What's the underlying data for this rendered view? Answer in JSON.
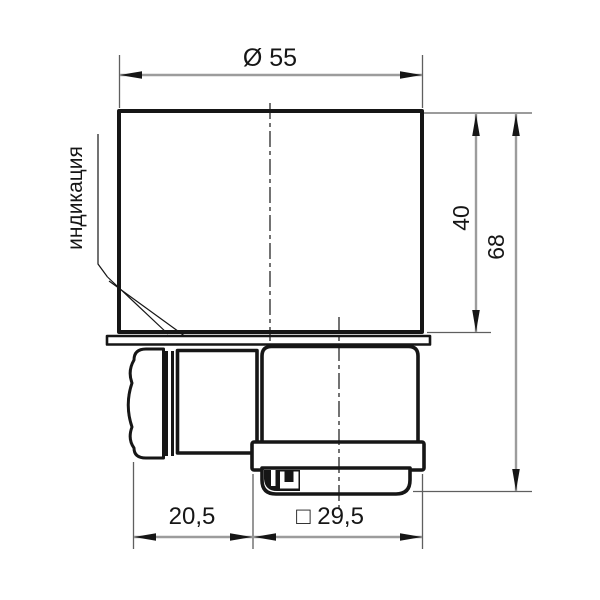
{
  "drawing": {
    "dimensions": {
      "diameter": "Ø 55",
      "body_height": "40",
      "total_height": "68",
      "gland_offset": "20,5",
      "connector_square": "□ 29,5"
    },
    "annotations": {
      "indication": "индикация"
    }
  },
  "colors": {
    "line": "#161616",
    "dimension": "#9c9c9c",
    "extension": "#5f5f5f",
    "text": "#161616",
    "background": "#ffffff"
  }
}
